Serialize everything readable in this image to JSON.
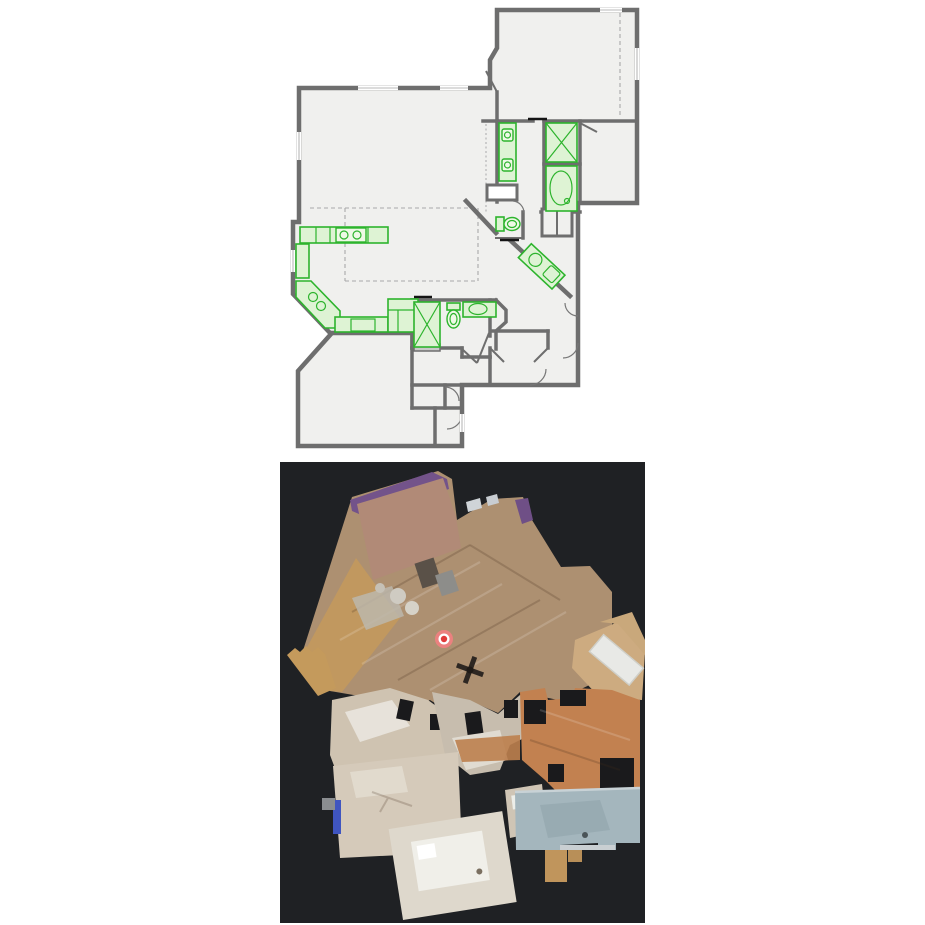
{
  "window": {
    "title": "Floor plan and 3D scan comparison",
    "background": "#ffffff"
  },
  "theme": {
    "--page-bg": "#ffffff",
    "--wall": "#6e6e6e",
    "--room": "#f0f0ee",
    "--fix": "#2db42d",
    "--fix-fill": "#def3d4",
    "--fix-fill-light": "#eef9e6",
    "--dash": "#a9a9a9",
    "--tick": "#141414",
    "--scan-bg": "#1f2124",
    "--wood": "#ad9071",
    "--gold": "#c49a5c",
    "--purple": "#73538a",
    "--cap": "#b18a77",
    "--terra": "#c28150",
    "--carpet": "#d5caba",
    "--carpet2": "#cfc3b1",
    "--bluegray": "#a4b6bd",
    "--bedwhite": "#f0efe9",
    "--accent-blue": "#3f55c0",
    "--mk-outer": "#f08080",
    "--mk-ring": "#ffffff",
    "--mk-core": "#e03a3a"
  },
  "floor_plan": {
    "label": "2D architectural floor plan",
    "colors": {
      "wall": "#6e6e6e",
      "room_fill": "#f0f0ee",
      "fixture_stroke": "#2db42d",
      "fixture_fill": "#def3d4",
      "dashed_line": "#a9a9a9",
      "door_tick": "#141414"
    },
    "fixtures": [
      "kitchen-counter",
      "cooktop",
      "kitchen-sink",
      "pantry-cabinet",
      "double-vanity",
      "walk-in-shower",
      "bathtub",
      "toilet",
      "hall-bath-shower",
      "hall-bath-toilet",
      "hall-bath-sink",
      "corner-vanity",
      "linen-closet"
    ]
  },
  "scan_view": {
    "label": "3D textured scan, top-down view",
    "background": "#1f2124",
    "marker": {
      "name": "current-camera-position",
      "x": 444,
      "y": 639,
      "outer_color": "#f08080",
      "ring_color": "#ffffff",
      "core_color": "#e03a3a"
    },
    "palette": {
      "wood_floor": "#ad9071",
      "golden_floor": "#c49a5c",
      "purple_wall": "#73538a",
      "terracotta_floor": "#c28150",
      "carpet_beige": "#d5caba",
      "blue_gray_floor": "#a4b6bd",
      "bed_white": "#f0efe9",
      "accent_blue": "#3f55c0"
    }
  }
}
